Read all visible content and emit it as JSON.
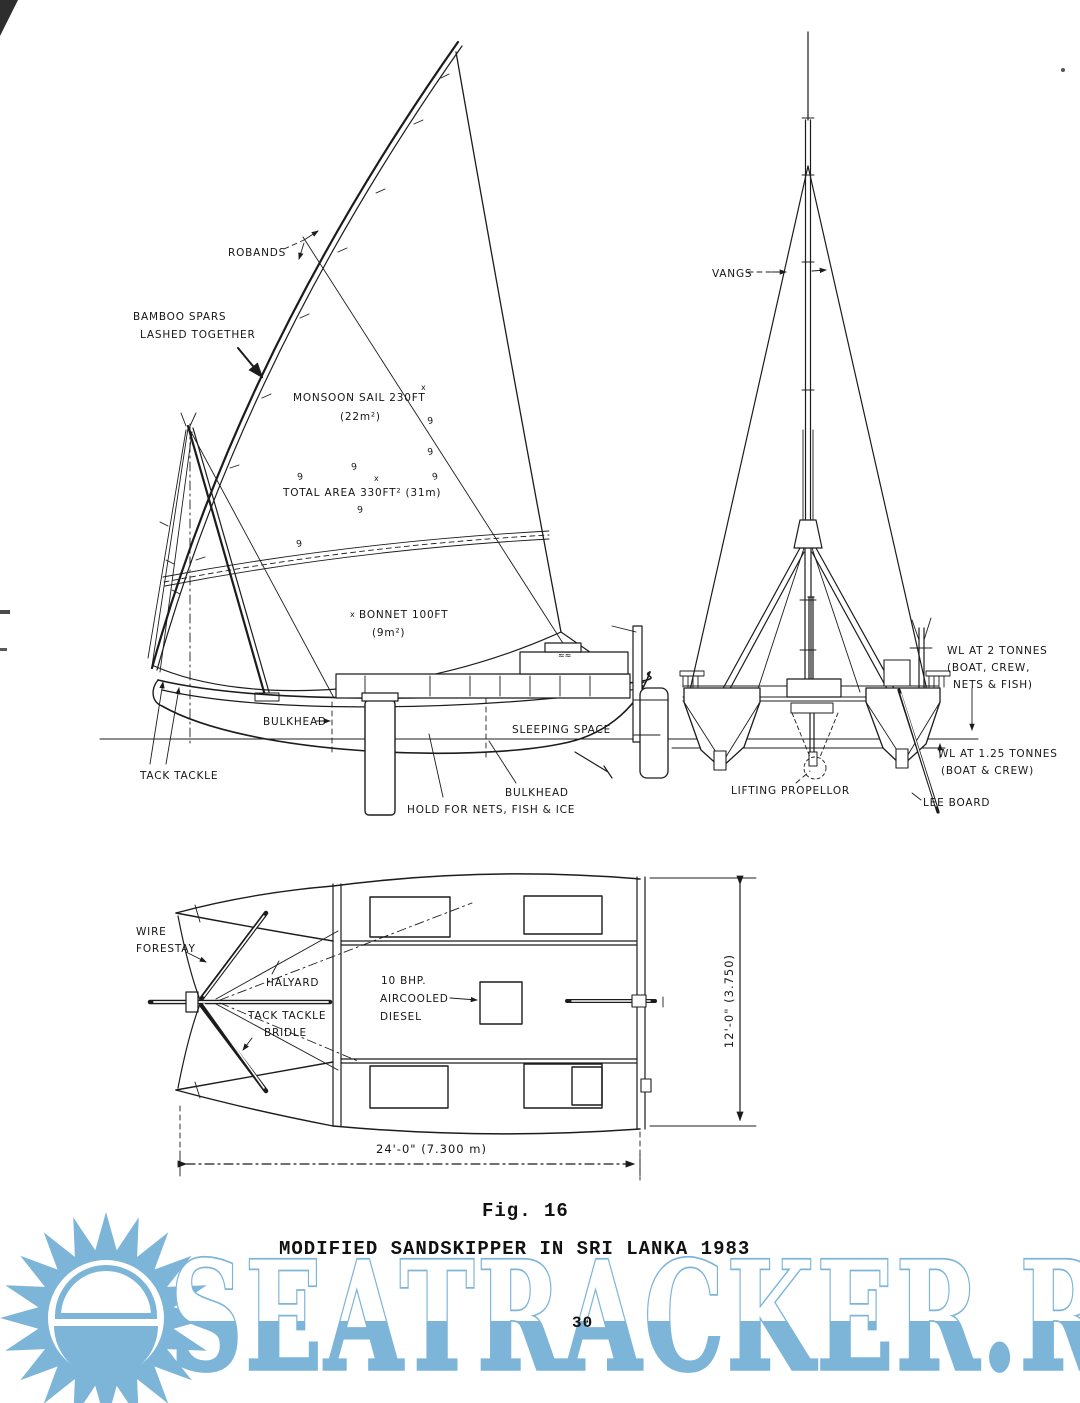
{
  "figure": {
    "caption": "Fig. 16",
    "title": "MODIFIED SANDSKIPPER IN SRI LANKA 1983",
    "page_number": "30"
  },
  "watermark": {
    "text": "SEATRACKER.RU",
    "color": "#7db5d9",
    "logo": "sun-logo"
  },
  "colors": {
    "ink": "#1c1c1c",
    "watermark_blue": "#7db5d9",
    "paper": "#ffffff"
  },
  "marks": {
    "reef_point": "9",
    "footnote": "x",
    "approx": "≈≈"
  },
  "side_view": {
    "description": "sail plan side elevation",
    "labels": {
      "robands": "ROBANDS",
      "bamboo_spars_line1": "BAMBOO SPARS",
      "bamboo_spars_line2": "LASHED TOGETHER",
      "monsoon_sail_line1": "MONSOON SAIL 230FT",
      "monsoon_sail_line2": "(22m²)",
      "total_area": "TOTAL AREA 330FT² (31m)",
      "bonnet_line1": "BONNET 100FT",
      "bonnet_line2": "(9m²)",
      "bulkhead_fwd": "BULKHEAD",
      "sleeping_space": "SLEEPING SPACE",
      "tack_tackle": "TACK TACKLE",
      "bulkhead_aft": "BULKHEAD",
      "hold": "HOLD FOR NETS, FISH & ICE"
    }
  },
  "front_view": {
    "description": "bow elevation of catamaran",
    "labels": {
      "vangs": "VANGS",
      "wl2_line1": "WL AT 2 TONNES",
      "wl2_line2": "(BOAT, CREW,",
      "wl2_line3": "NETS & FISH)",
      "wl125_line1": "WL AT 1.25 TONNES",
      "wl125_line2": "(BOAT & CREW)",
      "lifting_propellor": "LIFTING PROPELLOR",
      "lee_board": "LEE BOARD"
    }
  },
  "plan_view": {
    "description": "deck plan",
    "labels": {
      "wire_forestay_line1": "WIRE",
      "wire_forestay_line2": "FORESTAY",
      "halyard": "HALYARD",
      "tack_tackle_bridle_line1": "TACK TACKLE",
      "tack_tackle_bridle_line2": "BRIDLE",
      "engine_line1": "10 BHP.",
      "engine_line2": "AIRCOOLED",
      "engine_line3": "DIESEL"
    },
    "dimensions": {
      "beam": "12'-0\" (3.750)",
      "length": "24'-0\" (7.300 m)"
    }
  }
}
